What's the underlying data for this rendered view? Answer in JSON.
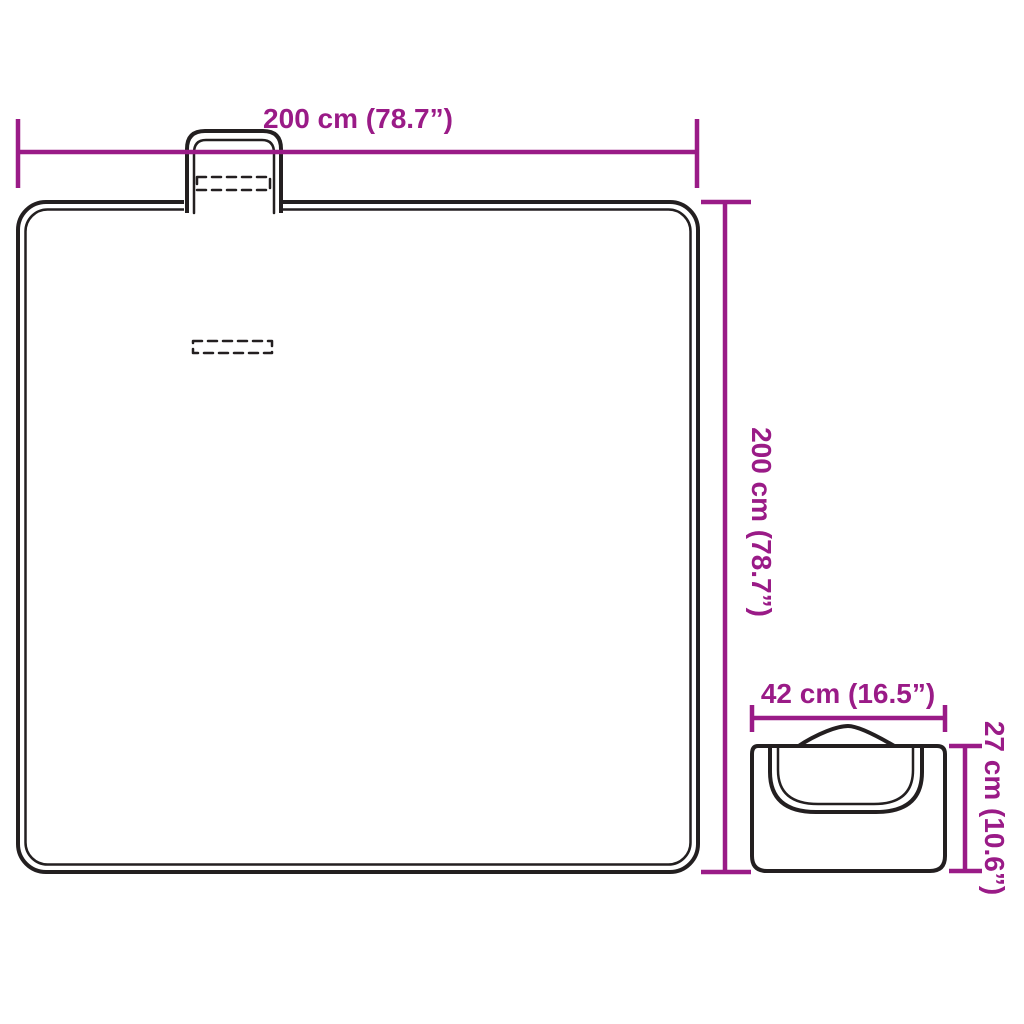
{
  "colors": {
    "accent": "#9A1B87",
    "line": "#231F20",
    "background": "#FFFFFF"
  },
  "diagram": {
    "unfolded_blanket": {
      "width_label": "200 cm (78.7”)",
      "height_label": "200 cm (78.7”)"
    },
    "folded_blanket": {
      "width_label": "42 cm (16.5”)",
      "height_label": "27 cm (10.6”)"
    }
  }
}
